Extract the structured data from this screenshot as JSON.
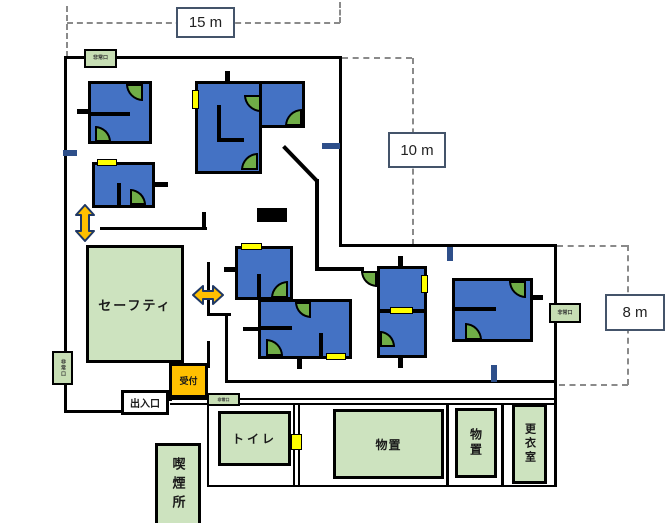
{
  "dimensions": {
    "top_width": "15 m",
    "upper_right_height": "10 m",
    "lower_right_height": "8 m"
  },
  "rooms": {
    "safety": "セーフティ",
    "reception": "受付",
    "entrance": "出入口",
    "toilet": "トイレ",
    "smoking": "喫煙所",
    "storage_large": "物置",
    "storage_small": "物置",
    "changing": "更衣室"
  },
  "signs": {
    "exit_top": "非常口",
    "exit_left": "非常口",
    "exit_right": "非常口",
    "exit_inner": "非常口"
  },
  "colors": {
    "room_blue": "#4472C4",
    "door_green": "#70AD47",
    "area_green": "#CDE3BF",
    "reception_orange": "#FFC000",
    "marker_yellow": "#FFFF00",
    "marker_navy": "#2E4F8A",
    "dimension_border": "#44546A"
  }
}
